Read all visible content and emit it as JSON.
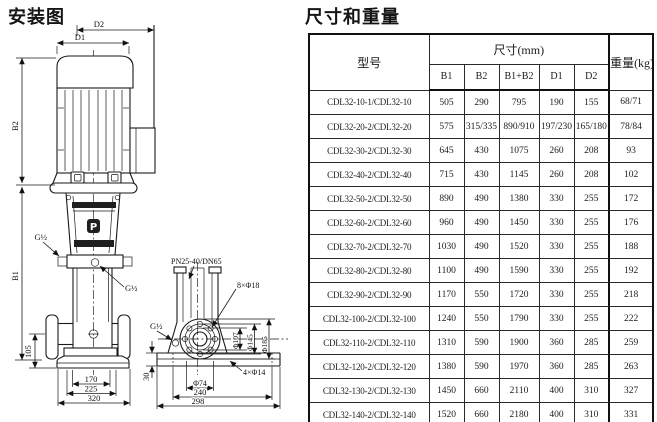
{
  "titles": {
    "installation": "安装图",
    "dimensions_weight": "尺寸和重量"
  },
  "diagram": {
    "brand_letter": "P",
    "labels": {
      "d1": "D1",
      "d2": "D2",
      "b1": "B1",
      "b2": "B2",
      "g_half_left": "G½",
      "g_half_head": "G½",
      "g_half_side": "G½",
      "dim_105": "105",
      "dim_170": "170",
      "dim_225": "225",
      "dim_320": "320",
      "flange_spec": "PN25-40/DN65",
      "flange_bolt_holes": "8×Φ18",
      "dia_inner": "Φ107",
      "dia_bolt_circle": "Φ145",
      "dia_outer": "Φ185",
      "dia_port": "Φ74",
      "dim_30": "30",
      "dim_240": "240",
      "dim_298": "298",
      "base_bolt_holes": "4×Φ14"
    }
  },
  "table": {
    "header": {
      "model": "型号",
      "dims_group": "尺寸(mm)",
      "weight": "重量(kg)",
      "dim_cols": [
        "B1",
        "B2",
        "B1+B2",
        "D1",
        "D2"
      ]
    },
    "rows": [
      [
        "CDL32-10-1/CDL32-10",
        "505",
        "290",
        "795",
        "190",
        "155",
        "68/71"
      ],
      [
        "CDL32-20-2/CDL32-20",
        "575",
        "315/335",
        "890/910",
        "197/230",
        "165/180",
        "78/84"
      ],
      [
        "CDL32-30-2/CDL32-30",
        "645",
        "430",
        "1075",
        "260",
        "208",
        "93"
      ],
      [
        "CDL32-40-2/CDL32-40",
        "715",
        "430",
        "1145",
        "260",
        "208",
        "102"
      ],
      [
        "CDL32-50-2/CDL32-50",
        "890",
        "490",
        "1380",
        "330",
        "255",
        "172"
      ],
      [
        "CDL32-60-2/CDL32-60",
        "960",
        "490",
        "1450",
        "330",
        "255",
        "176"
      ],
      [
        "CDL32-70-2/CDL32-70",
        "1030",
        "490",
        "1520",
        "330",
        "255",
        "188"
      ],
      [
        "CDL32-80-2/CDL32-80",
        "1100",
        "490",
        "1590",
        "330",
        "255",
        "192"
      ],
      [
        "CDL32-90-2/CDL32-90",
        "1170",
        "550",
        "1720",
        "330",
        "255",
        "218"
      ],
      [
        "CDL32-100-2/CDL32-100",
        "1240",
        "550",
        "1790",
        "330",
        "255",
        "222"
      ],
      [
        "CDL32-110-2/CDL32-110",
        "1310",
        "590",
        "1900",
        "360",
        "285",
        "259"
      ],
      [
        "CDL32-120-2/CDL32-120",
        "1380",
        "590",
        "1970",
        "360",
        "285",
        "263"
      ],
      [
        "CDL32-130-2/CDL32-130",
        "1450",
        "660",
        "2110",
        "400",
        "310",
        "327"
      ],
      [
        "CDL32-140-2/CDL32-140",
        "1520",
        "660",
        "2180",
        "400",
        "310",
        "331"
      ]
    ]
  }
}
